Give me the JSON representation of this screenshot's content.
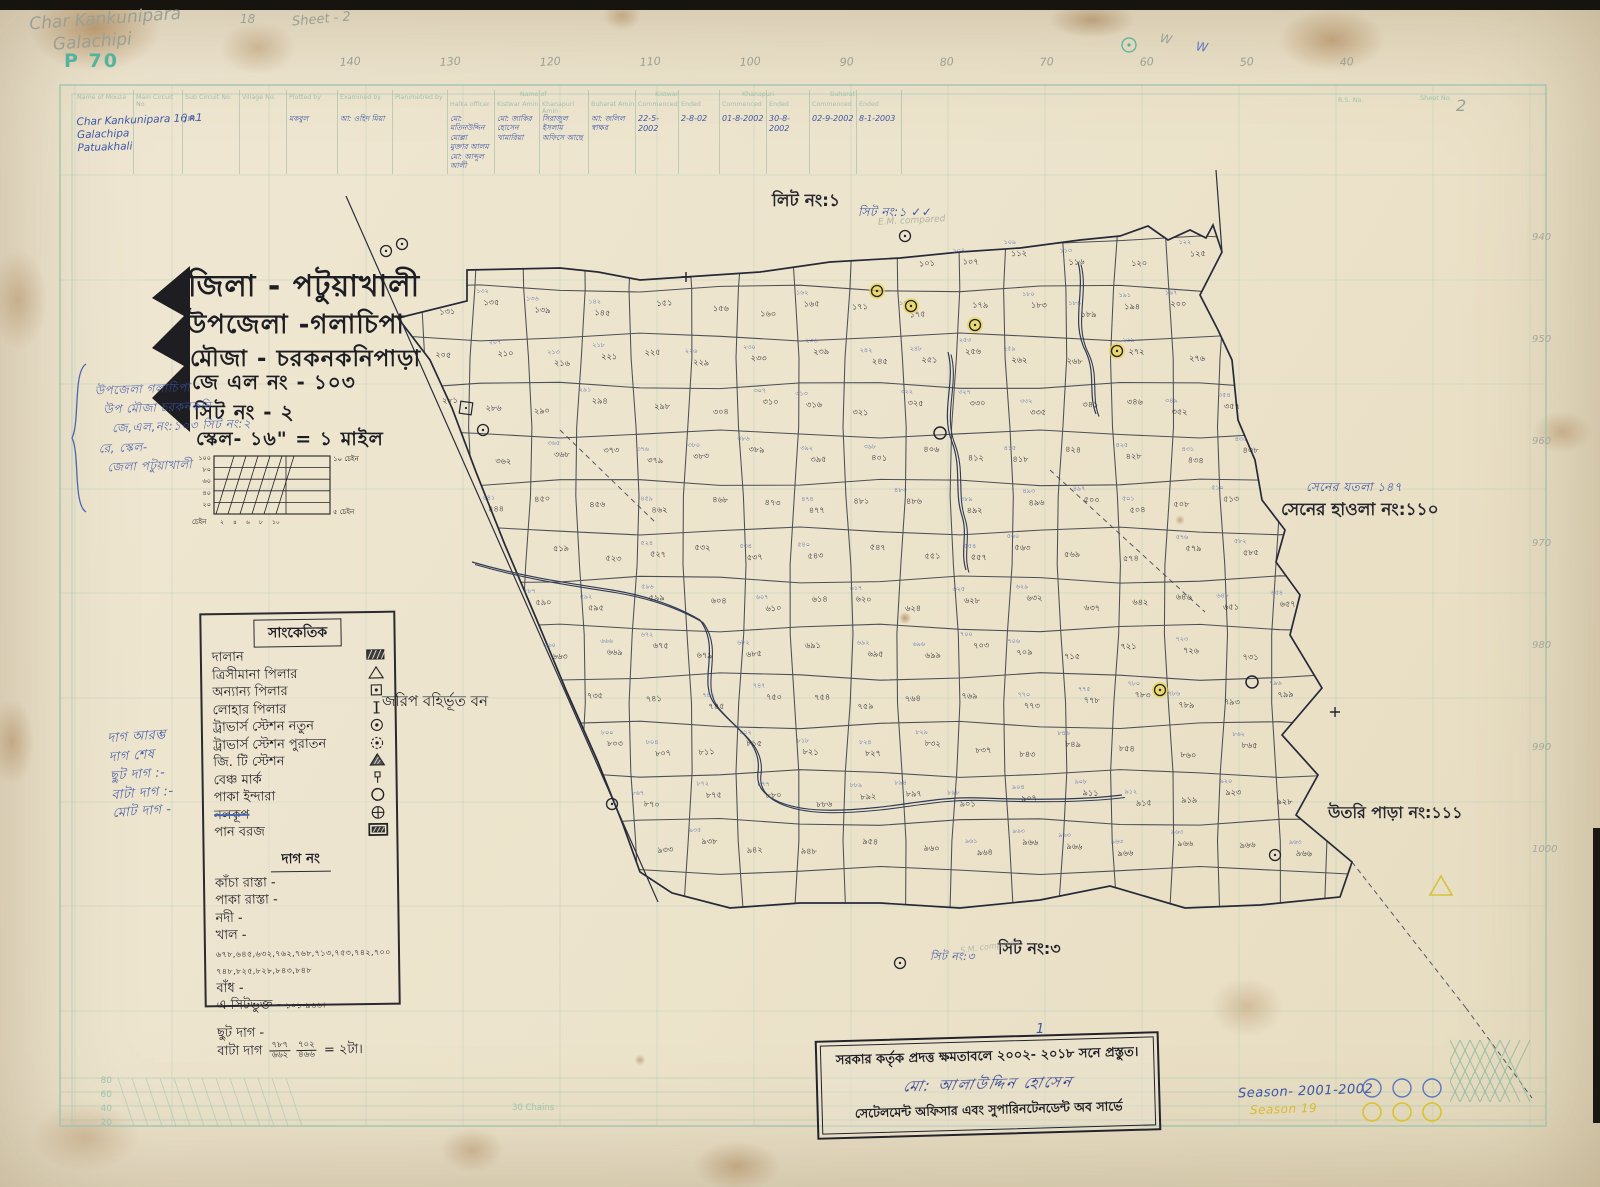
{
  "page": {
    "code": "P 70",
    "pencil_corner_line1": "Char Kankunipara",
    "pencil_corner_line2": "Galachipi",
    "pencil_top_num": "18",
    "pencil_top_sheet": "Sheet - 2",
    "pencil_w1": "W",
    "pencil_w2": "W",
    "sheet_no_pencil": "2"
  },
  "survey_table": {
    "groups": [
      "Name of",
      "Kistwar",
      "Khanapuri",
      "Buharat"
    ],
    "columns": [
      {
        "label": "Name of Mouza",
        "value": "Char Kankunipara 16=1\nGalachipa\nPatuakhali"
      },
      {
        "label": "Main Circuit No.",
        "value": ""
      },
      {
        "label": "Sub Circuit No.",
        "value": "J.R."
      },
      {
        "label": "Village No.",
        "value": ""
      },
      {
        "label": "Plotted by",
        "value": "মকবুল"
      },
      {
        "label": "Examined by",
        "value": "আ: ওহিদ মিয়া"
      },
      {
        "label": "Planimetred by",
        "value": ""
      },
      {
        "label": "Halka officer",
        "value": "মো: মতিনউদ্দিন মোল্লা\nমুক্তার আলম\nমো: আব্দুল আলী"
      },
      {
        "label": "Kistwar Amin",
        "value": "মো: জাকির হোসেন\nখামারিয়া"
      },
      {
        "label": "Khanapuri Amin",
        "value": "সিরাজুল ইসলাম\nঅফিসে আছে"
      },
      {
        "label": "Buharat Amin",
        "value": "আ: জলিল\nস্বাক্ষর"
      },
      {
        "label": "Commenced",
        "value": "22-5-2002"
      },
      {
        "label": "Ended",
        "value": "2-8-02"
      },
      {
        "label": "Commenced",
        "value": "01-8-2002"
      },
      {
        "label": "Ended",
        "value": "30-8-2002"
      },
      {
        "label": "Commenced",
        "value": "02-9-2002"
      },
      {
        "label": "Ended",
        "value": "8-1-2003"
      }
    ],
    "rs_label": "R.S. No.",
    "sheet_label": "Sheet No."
  },
  "title_block": {
    "line_district": "জিলা - পটুয়াখালী",
    "line_upazila": "উপজেলা -গলাচিপা",
    "line_mouza": "মৌজা - চরকনকনিপাড়া",
    "line_jl": "জে এল নং -  ১০৩",
    "line_sheet": "সিট নং - ২",
    "line_scale": "স্কেল- ১৬\" = ১ মাইল"
  },
  "blue_overwrites": [
    "উপজেলা গলাচিপা",
    "উপ মৌজা চরকনকনি",
    "জে,এল,নং:১০৩   সিট নং:২",
    "রে, স্কেল-",
    "জেলা পটুয়াখালী"
  ],
  "blue_left_notes": [
    "দাগ আরম্ভ",
    "দাগ শেষ",
    "ছুট দাগ :-",
    "বাটা দাগ :-",
    "মোট দাগ -"
  ],
  "scale_diagram": {
    "left_labels": [
      "১০০",
      "৮০",
      "৬০",
      "৪০",
      "২০"
    ],
    "top_right": "১০ চেইন",
    "bottom_right": "৫ চেইন",
    "bottom_left": "চেইন",
    "bottom_ticks": [
      "২",
      "৪",
      "৬",
      "৮",
      "১০"
    ]
  },
  "legend": {
    "title": "সাংকেতিক",
    "items": [
      {
        "label": "দালান",
        "symbol": "hatched-rect",
        "struck": false
      },
      {
        "label": "ত্রিসীমানা পিলার",
        "symbol": "triangle",
        "struck": false
      },
      {
        "label": "অন্যান্য পিলার",
        "symbol": "square-dot",
        "struck": false
      },
      {
        "label": "লোহার পিলার",
        "symbol": "iron-pillar",
        "struck": false
      },
      {
        "label": "ট্রাভার্স স্টেশন নতুন",
        "symbol": "circle-dot",
        "struck": false
      },
      {
        "label": "ট্রাভার্স স্টেশন পুরাতন",
        "symbol": "dashed-circle-dot",
        "struck": false
      },
      {
        "label": "জি. টি স্টেশন",
        "symbol": "hatched-triangle",
        "struck": false
      },
      {
        "label": "বেঞ্চ মার্ক",
        "symbol": "benchmark",
        "struck": false
      },
      {
        "label": "পাকা ইন্দারা",
        "symbol": "circle",
        "struck": false
      },
      {
        "label": "নলকূপ",
        "symbol": "circle-plus",
        "struck": true
      },
      {
        "label": "পান বরজ",
        "symbol": "bordered-hatch-rect",
        "struck": false
      }
    ],
    "dag_header": "দাগ নং",
    "dag_rows": [
      {
        "label": "কাঁচা রাস্তা -",
        "value": ""
      },
      {
        "label": "পাকা রাস্তা -",
        "value": ""
      },
      {
        "label": "নদী -",
        "value": ""
      },
      {
        "label": "খাল -",
        "value": "৬৭৮,৬৪৫,৬৩২,৭৬২,৭৬৮,৭১৩,৭৫৩,৭৪২,৭০০ ৭৪৮,৮২৫,৮২৮,৮৪৩,৮৪৮"
      },
      {
        "label": "বাঁধ -",
        "value": ""
      },
      {
        "label": "এ সিটভুক্ত -",
        "value": "১০১-৯৬৬।"
      }
    ],
    "chhut_dag": "ছুট দাগ -",
    "bata": {
      "label": "বাটা দাগ",
      "f1": [
        "৭৮৭",
        "৬৬২"
      ],
      "f2": [
        "৭০২",
        "৪৬৬"
      ],
      "result": "= ২টা।"
    }
  },
  "map": {
    "labels": {
      "lit_no_top": "লিট নং:১",
      "sit_no_top_blue": "সিট নং:১ ✓✓",
      "sit_no_bottom": "সিট নং:৩",
      "sit_no_bottom_blue": "সিট নং:৩",
      "seler_hawla_blue": "সেনের যতলা ১৪৭",
      "seler_hawla": "সেনের হাওলা নং:১১০",
      "utari_para": "উতরি পাড়া নং:১১১",
      "jorip_bon": "জরিপ বহির্ভূত বন",
      "pencil_em": "E.M. compared",
      "pencil_sm": "S.M. compared"
    },
    "plot_range": {
      "start": 101,
      "end": 966,
      "start_label": "১০১",
      "end_label": "৯৬৬"
    },
    "geometry": {
      "boundary": [
        [
          398,
          318
        ],
        [
          467,
          301
        ],
        [
          467,
          270
        ],
        [
          560,
          268
        ],
        [
          598,
          272
        ],
        [
          640,
          280
        ],
        [
          700,
          276
        ],
        [
          760,
          272
        ],
        [
          830,
          262
        ],
        [
          900,
          258
        ],
        [
          960,
          252
        ],
        [
          1020,
          248
        ],
        [
          1080,
          240
        ],
        [
          1120,
          236
        ],
        [
          1148,
          226
        ],
        [
          1168,
          240
        ],
        [
          1190,
          230
        ],
        [
          1206,
          238
        ],
        [
          1213,
          225
        ],
        [
          1222,
          252
        ],
        [
          1200,
          295
        ],
        [
          1218,
          330
        ],
        [
          1232,
          360
        ],
        [
          1238,
          420
        ],
        [
          1255,
          460
        ],
        [
          1262,
          500
        ],
        [
          1285,
          530
        ],
        [
          1276,
          562
        ],
        [
          1300,
          595
        ],
        [
          1290,
          635
        ],
        [
          1322,
          688
        ],
        [
          1282,
          735
        ],
        [
          1318,
          775
        ],
        [
          1296,
          815
        ],
        [
          1352,
          862
        ],
        [
          1340,
          897
        ],
        [
          1260,
          905
        ],
        [
          1185,
          908
        ],
        [
          1110,
          886
        ],
        [
          1040,
          900
        ],
        [
          960,
          908
        ],
        [
          880,
          903
        ],
        [
          800,
          903
        ],
        [
          730,
          908
        ],
        [
          672,
          893
        ],
        [
          640,
          872
        ],
        [
          622,
          822
        ],
        [
          598,
          762
        ],
        [
          566,
          690
        ],
        [
          536,
          618
        ],
        [
          505,
          545
        ],
        [
          476,
          472
        ],
        [
          452,
          408
        ],
        [
          430,
          360
        ]
      ],
      "solid_lines": [
        [
          346,
          196,
          658,
          902
        ],
        [
          1216,
          170,
          1222,
          252
        ]
      ],
      "dashed_lines": [
        [
          1352,
          862,
          1466,
          1008
        ],
        [
          1466,
          1008,
          1532,
          1098
        ],
        [
          1050,
          470,
          1205,
          612
        ],
        [
          560,
          430,
          655,
          522
        ]
      ],
      "canals": [
        "M700,620 C722,650 696,682 716,706 C736,730 762,742 758,772 C754,800 792,812 842,810 C900,808 932,796 982,798 C1032,800 1082,800 1122,795",
        "M948,352 C956,382 940,412 952,442 C962,468 954,492 962,516 C968,534 960,552 966,570",
        "M1078,262 C1086,292 1070,322 1086,352 C1096,374 1088,394 1096,414",
        "M472,562 C520,576 560,582 612,590 C648,596 676,606 700,620"
      ],
      "symbols": [
        {
          "x": 386,
          "y": 251,
          "t": "c"
        },
        {
          "x": 402,
          "y": 244,
          "t": "c"
        },
        {
          "x": 905,
          "y": 236,
          "t": "c"
        },
        {
          "x": 877,
          "y": 291,
          "t": "cy"
        },
        {
          "x": 911,
          "y": 306,
          "t": "cy"
        },
        {
          "x": 975,
          "y": 325,
          "t": "cy"
        },
        {
          "x": 1117,
          "y": 351,
          "t": "cy"
        },
        {
          "x": 940,
          "y": 433,
          "t": "cd"
        },
        {
          "x": 483,
          "y": 430,
          "t": "c"
        },
        {
          "x": 466,
          "y": 408,
          "t": "sq"
        },
        {
          "x": 1252,
          "y": 682,
          "t": "cd"
        },
        {
          "x": 1275,
          "y": 855,
          "t": "c"
        },
        {
          "x": 900,
          "y": 963,
          "t": "c"
        },
        {
          "x": 612,
          "y": 804,
          "t": "c"
        },
        {
          "x": 1335,
          "y": 712,
          "t": "plus"
        },
        {
          "x": 686,
          "y": 277,
          "t": "plus"
        },
        {
          "x": 1160,
          "y": 690,
          "t": "cy"
        }
      ]
    }
  },
  "rulers": {
    "top_pencil": [
      "140",
      "130",
      "120",
      "110",
      "100",
      "90",
      "80",
      "70",
      "60",
      "50",
      "40"
    ],
    "right_pencil": [
      "940",
      "950",
      "960",
      "970",
      "980",
      "990",
      "1000"
    ],
    "bottom_scale_labels": [
      "80",
      "60",
      "40",
      "20"
    ],
    "bottom_chains": "30 Chains"
  },
  "footer": {
    "season_blue": "Season- 2001-2002",
    "season_yellow": "Season 19"
  },
  "stamp": {
    "line1": "সরকার কর্তৃক প্রদত্ত ক্ষমতাবলে ২০০২- ২০১৮  সনে প্রস্তুত।",
    "signature": "মো: আলাউদ্দিন হোসেন",
    "line2": "সেটেলমেন্ট অফিসার এবং সুপারিনটেনডেন্ট অব সার্ভে",
    "mark_above": "1"
  }
}
